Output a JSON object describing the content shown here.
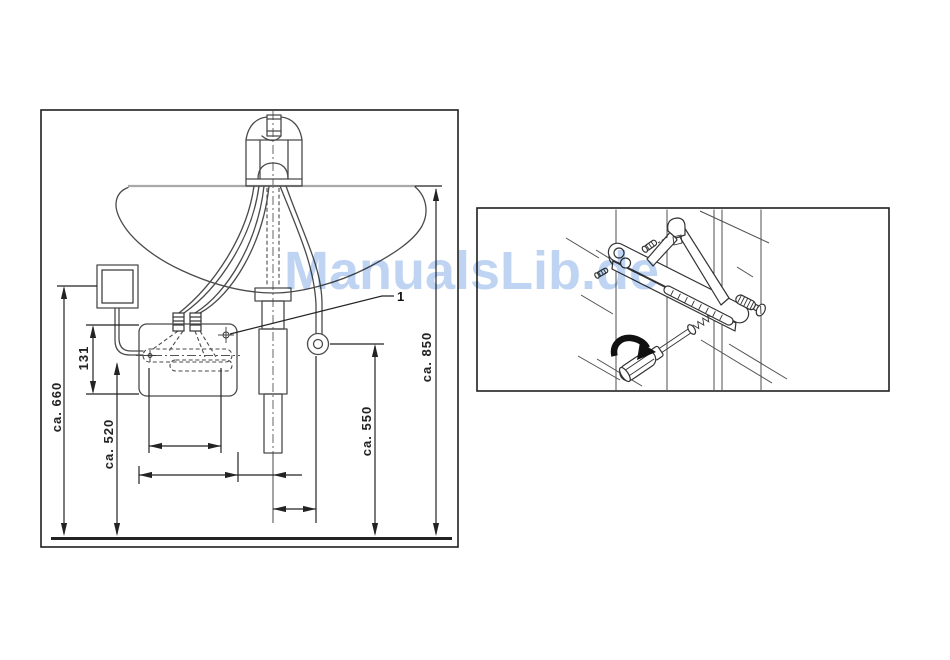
{
  "watermark": {
    "text": "ManualsLib.de",
    "color_hex": "#bfd4f2"
  },
  "colors": {
    "background": "#ffffff",
    "dimension_ink": "#232323",
    "fixture_ink": "#4a4a4a",
    "frame_ink": "#1f1f1f"
  },
  "installation_figure": {
    "callout_1": "1",
    "dimensions": [
      {
        "id": "overall-height",
        "label": "ca. 660"
      },
      {
        "id": "heater-height",
        "label": "131"
      },
      {
        "id": "connection-height",
        "label": "ca. 520"
      },
      {
        "id": "outlet-height",
        "label": "ca. 550"
      },
      {
        "id": "rim-height",
        "label": "ca. 850"
      }
    ]
  }
}
